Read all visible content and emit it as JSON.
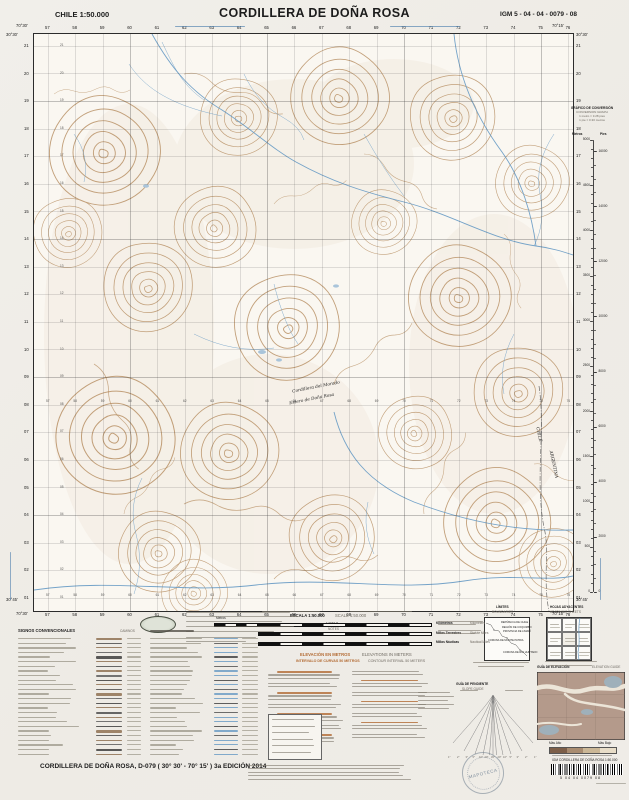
{
  "header": {
    "country_scale": "CHILE  1:50.000",
    "title": "CORDILLERA DE DOÑA ROSA",
    "sheet_code": "IGM 5 - 04 - 04 - 0079 - 08"
  },
  "map": {
    "corners": {
      "lat_top": "30°30'",
      "lat_bottom": "30°45'",
      "lon_west": "70°30'",
      "lon_east": "70°15'"
    },
    "grid_top": [
      "57",
      "58",
      "59",
      "60",
      "61",
      "62",
      "63",
      "64",
      "65",
      "66",
      "67",
      "68",
      "69",
      "70",
      "71",
      "72",
      "73",
      "74",
      "75",
      "76"
    ],
    "grid_left": [
      "21",
      "20",
      "19",
      "18",
      "17",
      "16",
      "15",
      "14",
      "13",
      "12",
      "11",
      "10",
      "09",
      "08",
      "07",
      "06",
      "05",
      "04",
      "03",
      "02",
      "01"
    ],
    "labels": [
      {
        "text": "Cordillera del Morado",
        "x": 258,
        "y": 351,
        "rot": -11
      },
      {
        "text": "Estero de Doña Rosa",
        "x": 255,
        "y": 363,
        "rot": -11
      }
    ],
    "boundary_labels": {
      "left": "CHILE",
      "right": "ARGENTINA"
    }
  },
  "conversion": {
    "title": "GRÁFICO DE CONVERSIÓN",
    "subtitle": "CONVERSION GRAPH",
    "note1": "1 metro = 3.28 pies",
    "note2": "1 pie = 0.30 metros",
    "col_left": "Metros",
    "col_right": "Pies",
    "meters_max": 5000,
    "meters_step": 500,
    "feet_labels": [
      16000,
      14000,
      12000,
      10000,
      8000,
      6000,
      4000,
      2000,
      0
    ]
  },
  "scale": {
    "escala": "ESCALA 1:50.000",
    "scale_en": "SCALE 1:50.000",
    "left_unit": "Metros",
    "bars": [
      {
        "es": "Kilómetros",
        "en": "Kilometers"
      },
      {
        "es": "Millas Terrestres",
        "en": "Statute Miles"
      },
      {
        "es": "Millas Náuticas",
        "en": "Nautical Miles"
      }
    ]
  },
  "elevation_note": {
    "es1": "ELEVACIÓN EN METROS",
    "en1": "ELEVATIONS IN METERS",
    "es2": "INTERVALO DE CURVAS 50 METROS",
    "en2": "CONTOUR INTERVAL 50 METERS"
  },
  "signos": {
    "title": "SIGNOS CONVENCIONALES",
    "col_right": "CAMINOS"
  },
  "notas": {
    "es": "NOTAS",
    "en": "NOTES"
  },
  "limites": {
    "title": "LÍMITES",
    "subtitle": "BOUNDARIES",
    "labels": [
      "REPÚBLICA DE CHILE",
      "REGIÓN DE COQUIMBO",
      "PROVINCIA DE LIMARÍ",
      "COMUNA DE MONTE PATRIA",
      "COMUNA DE RÍO HURTADO"
    ]
  },
  "hojas": {
    "title": "HOJAS ADYACENTES",
    "subtitle": "ADJOINING SHEETS"
  },
  "pendiente": {
    "title": "GUÍA DE PENDIENTE",
    "subtitle": "SLOPE GUIDE",
    "degrees": [
      "45°",
      "20°",
      "10°",
      "5°",
      "3°",
      "2°",
      "1°"
    ]
  },
  "elev_guide": {
    "title": "GUÍA DE ELEVACIÓN",
    "subtitle": "ELEVATION GUIDE",
    "high": "Más Alto",
    "low": "Más Bajo"
  },
  "stamp": "MAPOTECA",
  "footer": {
    "title": "CORDILLERA DE DOÑA ROSA, D-079 ( 30° 30' - 70° 15' ) 3a EDICIÓN 2014",
    "barcode_label": "IGM   CORDILLERA DE DOÑA ROSA   1:50.000",
    "digits": "5    04    04    0079    08"
  }
}
